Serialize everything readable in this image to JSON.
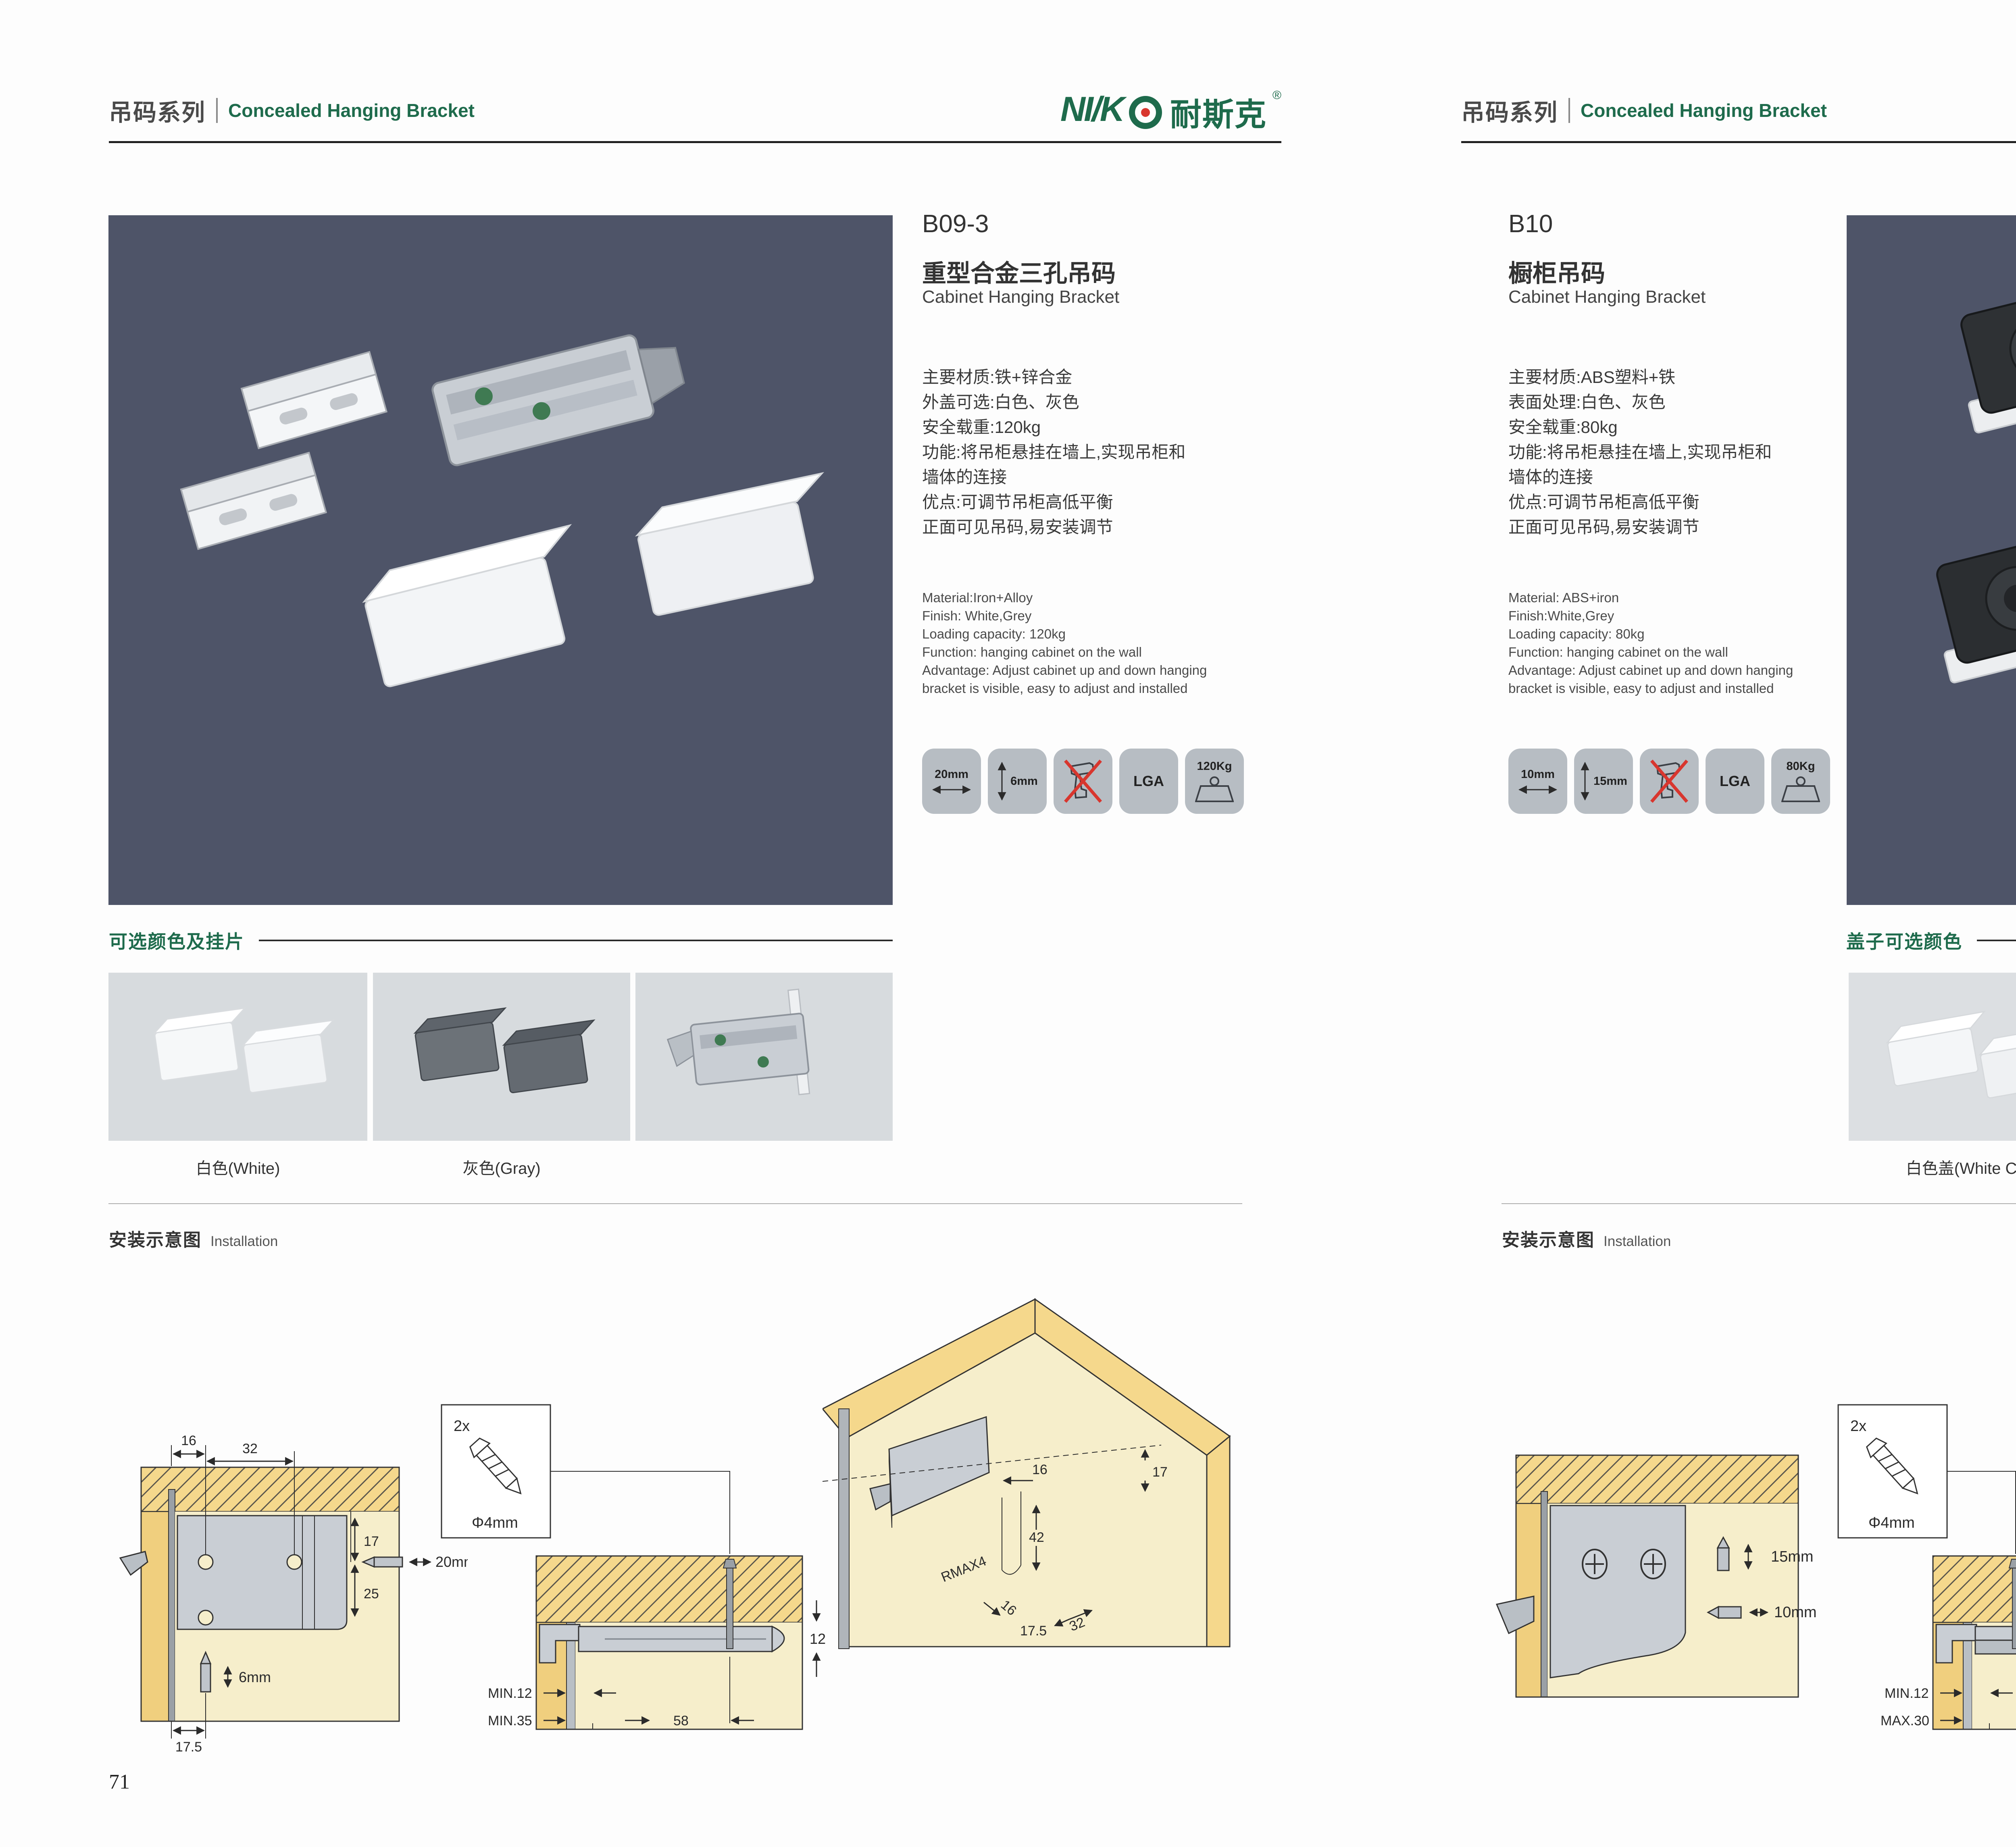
{
  "brand": {
    "logo_latin": "NI/K",
    "logo_cn": "耐斯克",
    "logo_reg": "®"
  },
  "theme": {
    "green": "#1e6b4c",
    "photo_bg": "#4e5468",
    "badge_bg": "#b7bdc3",
    "swatch_bg": "#d7dbde",
    "red": "#d8362e",
    "wood": "#f5d88c",
    "cream": "#f6eecb",
    "metal": "#c9ced4"
  },
  "left_page": {
    "header": {
      "series_cn": "吊码系列",
      "series_en": "Concealed Hanging Bracket"
    },
    "product": {
      "code": "B09-3",
      "name_cn": "重型合金三孔吊码",
      "name_en": "Cabinet Hanging Bracket",
      "specs_cn": [
        "主要材质:铁+锌合金",
        "外盖可选:白色、灰色",
        "安全载重:120kg",
        "功能:将吊柜悬挂在墙上,实现吊柜和",
        "墙体的连接",
        "优点:可调节吊柜高低平衡",
        "正面可见吊码,易安装调节"
      ],
      "specs_en": [
        "Material:Iron+Alloy",
        "Finish: White,Grey",
        "Loading capacity: 120kg",
        "Function: hanging cabinet on the wall",
        "Advantage: Adjust cabinet up and down hanging",
        "bracket is visible, easy to adjust and installed"
      ],
      "badges": [
        {
          "label": "20mm"
        },
        {
          "label": "6mm"
        },
        {
          "label": ""
        },
        {
          "label": "LGA"
        },
        {
          "label": "120Kg"
        }
      ]
    },
    "colors": {
      "title": "可选颜色及挂片",
      "labels": [
        "白色(White)",
        "灰色(Gray)"
      ]
    },
    "install": {
      "title_cn": "安装示意图",
      "title_en": "Installation"
    },
    "diagram1": {
      "d16": "16",
      "d32": "32",
      "d17": "17",
      "d25": "25",
      "d20mm": "20mm",
      "d6mm": "6mm",
      "d175": "17.5"
    },
    "diagram2": {
      "qty": "2x",
      "dia": "Φ4mm",
      "d12": "12",
      "min12": "MIN.12",
      "min35": "MIN.35",
      "d58": "58"
    },
    "diagram3": {
      "d17": "17",
      "d16a": "16",
      "d42": "42",
      "rmax": "RMAX4",
      "d16b": "16",
      "d175": "17.5",
      "d32": "32"
    },
    "page_number": "71"
  },
  "right_page": {
    "header": {
      "series_cn": "吊码系列",
      "series_en": "Concealed Hanging Bracket"
    },
    "product": {
      "code": "B10",
      "name_cn": "橱柜吊码",
      "name_en": "Cabinet Hanging Bracket",
      "specs_cn": [
        "主要材质:ABS塑料+铁",
        "表面处理:白色、灰色",
        "安全载重:80kg",
        "功能:将吊柜悬挂在墙上,实现吊柜和",
        "墙体的连接",
        "优点:可调节吊柜高低平衡",
        "正面可见吊码,易安装调节"
      ],
      "specs_en": [
        "Material: ABS+iron",
        "Finish:White,Grey",
        "Loading capacity: 80kg",
        "Function: hanging cabinet on the wall",
        "Advantage: Adjust cabinet up and down hanging",
        "bracket is visible, easy to adjust and installed"
      ],
      "badges": [
        {
          "label": "10mm"
        },
        {
          "label": "15mm"
        },
        {
          "label": ""
        },
        {
          "label": "LGA"
        },
        {
          "label": "80Kg"
        }
      ]
    },
    "colors": {
      "title": "盖子可选颜色",
      "labels": [
        "白色盖(White Cap)",
        "灰色盖(Gray Cap)"
      ]
    },
    "install": {
      "title_cn": "安装示意图",
      "title_en": "Installation"
    },
    "diagram1": {
      "d15mm": "15mm",
      "d10mm": "10mm"
    },
    "diagram2": {
      "qty": "2x",
      "dia": "Φ4mm",
      "d18": "18",
      "min12": "MIN.12",
      "max30": "MAX.30",
      "d67": "67"
    },
    "diagram3": {
      "d13": "13",
      "d42": "42",
      "rmax": "RMAX4",
      "d19": "19",
      "d17": "17",
      "d32": "32"
    },
    "page_number": "72"
  }
}
